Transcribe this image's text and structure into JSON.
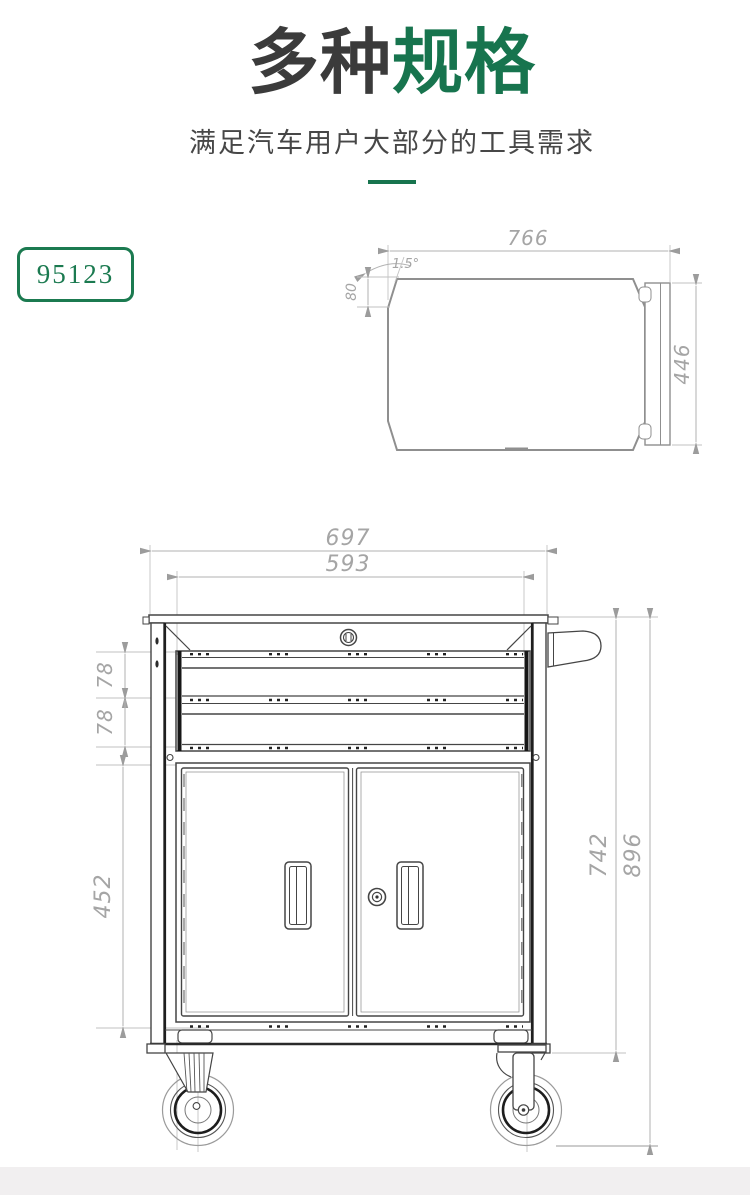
{
  "header": {
    "title_primary": "多种",
    "title_accent": "规格",
    "subtitle": "满足汽车用户大部分的工具需求"
  },
  "model_badge": {
    "label": "95123"
  },
  "colors": {
    "accent_green": "#17744e",
    "badge_green": "#1b7a50",
    "title_dark": "#3b3b3b",
    "drawing_line": "#454545",
    "dim_text": "#a5a5a5"
  },
  "top_view": {
    "dim_width": "766",
    "dim_height": "446",
    "dim_angle": "1.5°",
    "dim_edge": "80"
  },
  "front_view": {
    "dim_overall_width": "697",
    "dim_drawer_width": "593",
    "dim_drawer1_height": "78",
    "dim_drawer2_height": "78",
    "dim_door_height": "452",
    "dim_body_height": "742",
    "dim_overall_height": "896"
  }
}
